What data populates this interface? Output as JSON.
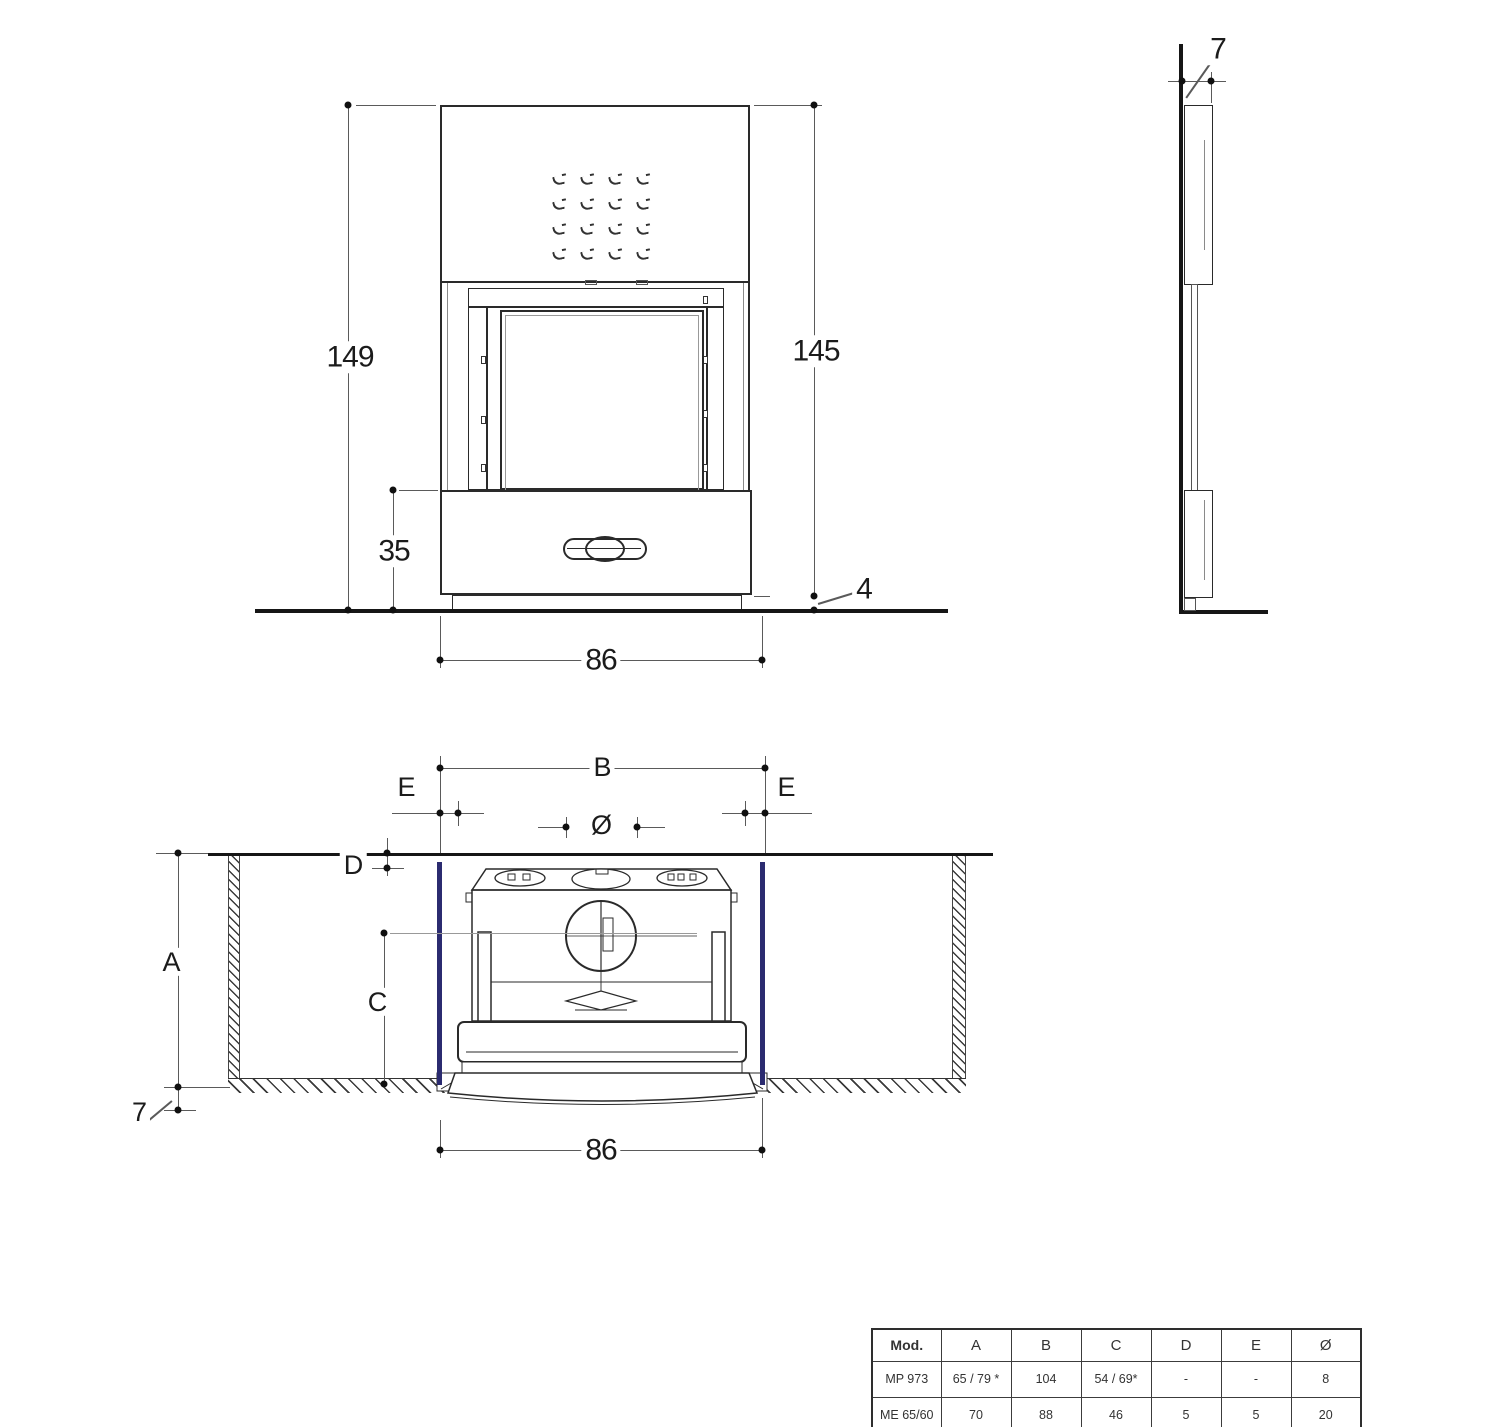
{
  "drawing": {
    "front_view": {
      "dims": {
        "overall_height": "149",
        "body_height": "145",
        "base_height": "35",
        "width": "86",
        "floor_gap": "4"
      }
    },
    "side_view": {
      "dims": {
        "depth": "7"
      }
    },
    "section_view": {
      "dims": {
        "niche_depth": "A",
        "niche_width": "B",
        "insert_height": "C",
        "top_gap": "D",
        "side_gap": "E",
        "flue_diameter": "Ø",
        "insert_width": "86",
        "floor_drop": "7"
      }
    },
    "vents": {
      "rows": 4,
      "cols": 4,
      "col_step": 28,
      "row_step": 25
    },
    "colors": {
      "accent_blue": "#2b2b70",
      "line_dark": "#2a2a2a"
    },
    "table": {
      "headers": [
        "Mod.",
        "A",
        "B",
        "C",
        "D",
        "E",
        "Ø"
      ],
      "rows": [
        [
          "MP 973",
          "65 / 79 *",
          "104",
          "54 / 69*",
          "-",
          "-",
          "8"
        ],
        [
          "ME 65/60",
          "70",
          "88",
          "46",
          "5",
          "5",
          "20"
        ]
      ]
    }
  }
}
